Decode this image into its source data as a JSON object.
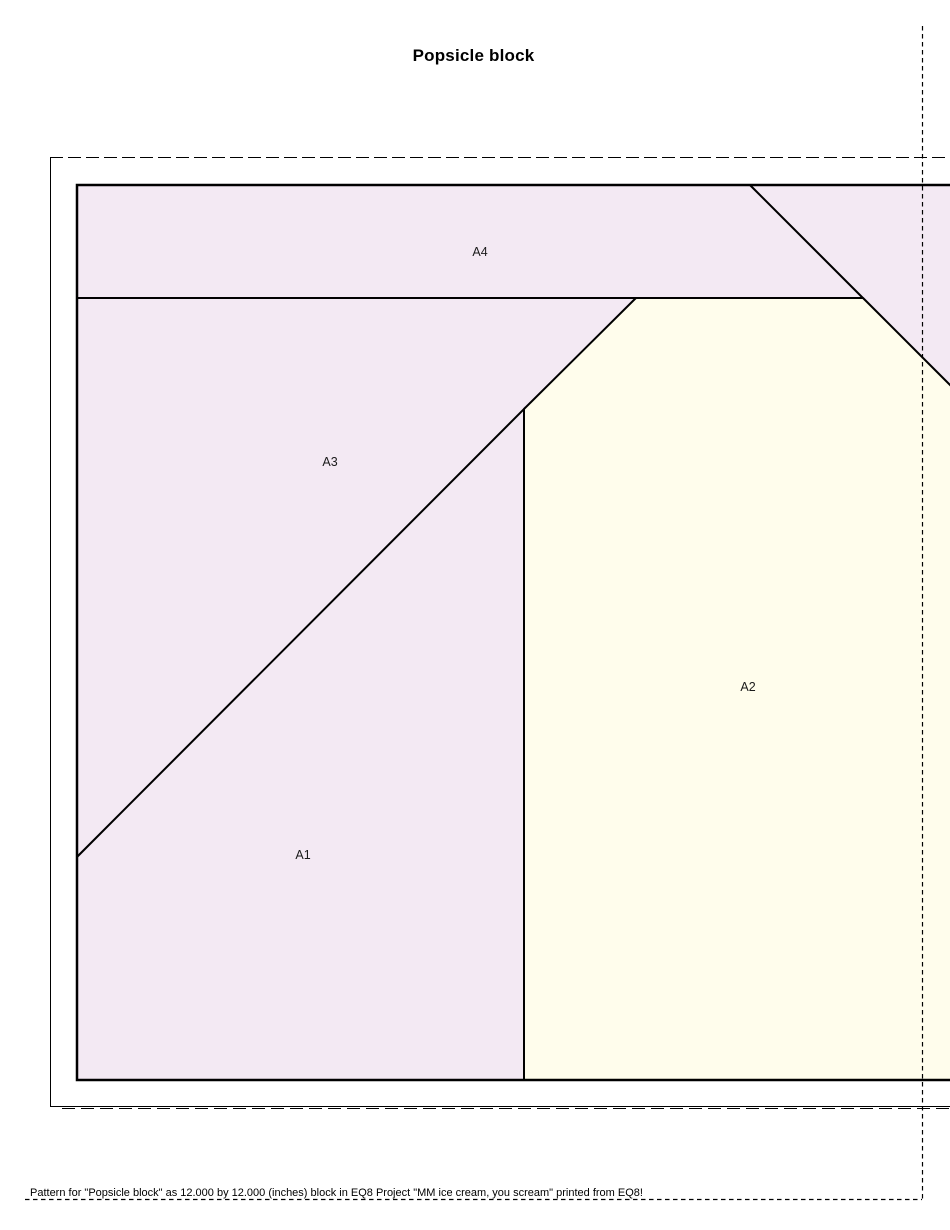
{
  "page": {
    "title": "Popsicle block",
    "footer": "Pattern for  \"Popsicle block\"  as 12.000 by 12.000 (inches) block in EQ8 Project \"MM ice cream, you scream\" printed from EQ8!"
  },
  "block": {
    "name": "Popsicle block",
    "size": "12.000 by 12.000 (inches)",
    "project": "MM ice cream, you scream",
    "source_app": "EQ8",
    "pieces": [
      {
        "label": "A1",
        "fabric": "lavender"
      },
      {
        "label": "A2",
        "fabric": "cream"
      },
      {
        "label": "A3",
        "fabric": "lavender"
      },
      {
        "label": "A4",
        "fabric": "lavender"
      },
      {
        "label": "",
        "fabric": "lavender"
      }
    ]
  },
  "colors": {
    "lavender": "#f3e9f3",
    "cream": "#fffdec",
    "seam_line": "#000000",
    "guide_line": "#000000"
  }
}
